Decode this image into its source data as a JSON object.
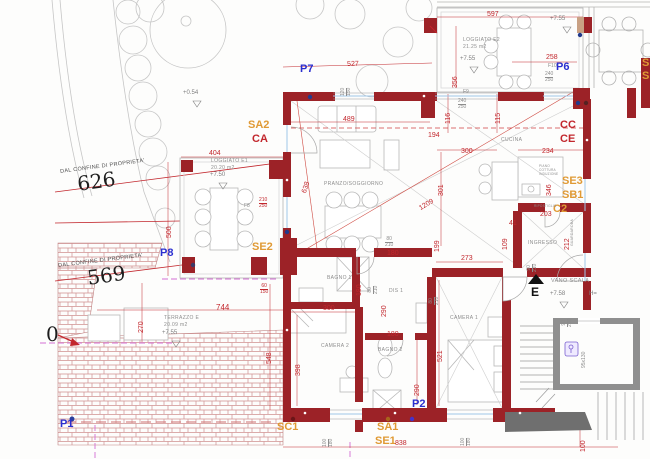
{
  "title": "Apartment floor plan",
  "colors": {
    "wall": "#9c2227",
    "dim": "#c2272d",
    "marker_blue": "#2b2fd0",
    "marker_orange": "#e09a35",
    "marker_red": "#c2272d",
    "stair_gray": "#8f8f8f",
    "magenta": "#d46fd4",
    "furniture_gray": "#b8b8b8"
  },
  "markers": {
    "p1": "P1",
    "p2": "P2",
    "p6": "P6",
    "p7": "P7",
    "p8": "P8",
    "sa1": "SA1",
    "sa2": "SA2",
    "sc1": "SC1",
    "se1": "SE1",
    "se2": "SE2",
    "se3": "SE3",
    "sb1": "SB1",
    "c2": "C2",
    "ca": "CA",
    "cc": "CC",
    "ce": "CE",
    "s_cut1": "S",
    "s_cut2": "S"
  },
  "rooms": {
    "living": "PRANZO/SOGGIORNO",
    "kitchen": "CUCINA",
    "entry": "INGRESSO",
    "bath1": "BAGNO 1",
    "hall": "DIS 1",
    "bed2": "CAMERA 2",
    "bath2": "BAGNO 2",
    "bed1": "CAMERA 1",
    "loggia1": "LOGGIATO E1",
    "loggia1_area": "20.20 m2",
    "loggia2": "LOGGIATO E2",
    "loggia2_area": "21.25 m2",
    "terrace": "TERRAZZO E",
    "terrace_area": "20.09 m2",
    "stairwell": "VANO SCALA",
    "closet": "GUARDAROBA",
    "storage": "RIPOSTIGLIO",
    "cook1": "PIANO",
    "cook2": "COTTURA",
    "cook3": "INDUZIONE"
  },
  "dims": {
    "d597": "597",
    "d527": "527",
    "d489": "489",
    "d404": "404",
    "d258": "258",
    "d744": "744",
    "d838": "838",
    "d356": "356",
    "d301": "301",
    "d199": "199",
    "d116": "116",
    "d115": "115",
    "d194": "194",
    "d300_kitchen": "300",
    "d234": "234",
    "d346": "346",
    "d203": "203",
    "d41": "41",
    "d109": "109",
    "d212": "212",
    "d273": "273",
    "d521": "521",
    "d398": "398",
    "d290_hall": "290",
    "d290_bath2": "290",
    "d180_hall": "180",
    "d180_bath2": "180",
    "d180_bath1": "180",
    "d300_bed2": "300",
    "d270": "270",
    "d548": "548",
    "d500": "500",
    "d100": "100",
    "d638": "638",
    "d1209": "1209"
  },
  "openings": {
    "f8": "F8",
    "f8_w": "210",
    "f8_h": "250",
    "f9": "F9",
    "f9_w": "240",
    "f9_h": "250",
    "f10": "F10",
    "f10_w": "240",
    "f10_h": "250",
    "win_living_w": "120",
    "win_living_h": "150",
    "par_w": "60",
    "par_h": "150",
    "win_bed2_w": "100",
    "win_bed2_h": "180",
    "win_bed1_w": "100",
    "win_bed1_h": "180",
    "door_hall1_w": "80",
    "door_hall1_h": "210",
    "door_hall2_w": "80",
    "door_hall2_h": "210",
    "door_hall3_w": "80",
    "door_hall3_h": "210",
    "door_entry_w": "90",
    "door_entry_h": "210",
    "door_stair_w": "90",
    "door_stair_h": "200",
    "lift": "95x130"
  },
  "levels": {
    "garden": "+0.54",
    "loggia2_a": "+7.55",
    "loggia2_b": "+7.55",
    "loggia1": "+7.50",
    "terrace": "+7.55",
    "landing": "+7.58",
    "h_cut": "H=",
    "east": "E"
  },
  "boundary": {
    "n626": "626",
    "n569": "569",
    "conf1": "DAL CONFINE DI PROPRIETA'",
    "conf2": "DAL CONFINE DI PROPRIETA'",
    "n_cut": "0"
  }
}
